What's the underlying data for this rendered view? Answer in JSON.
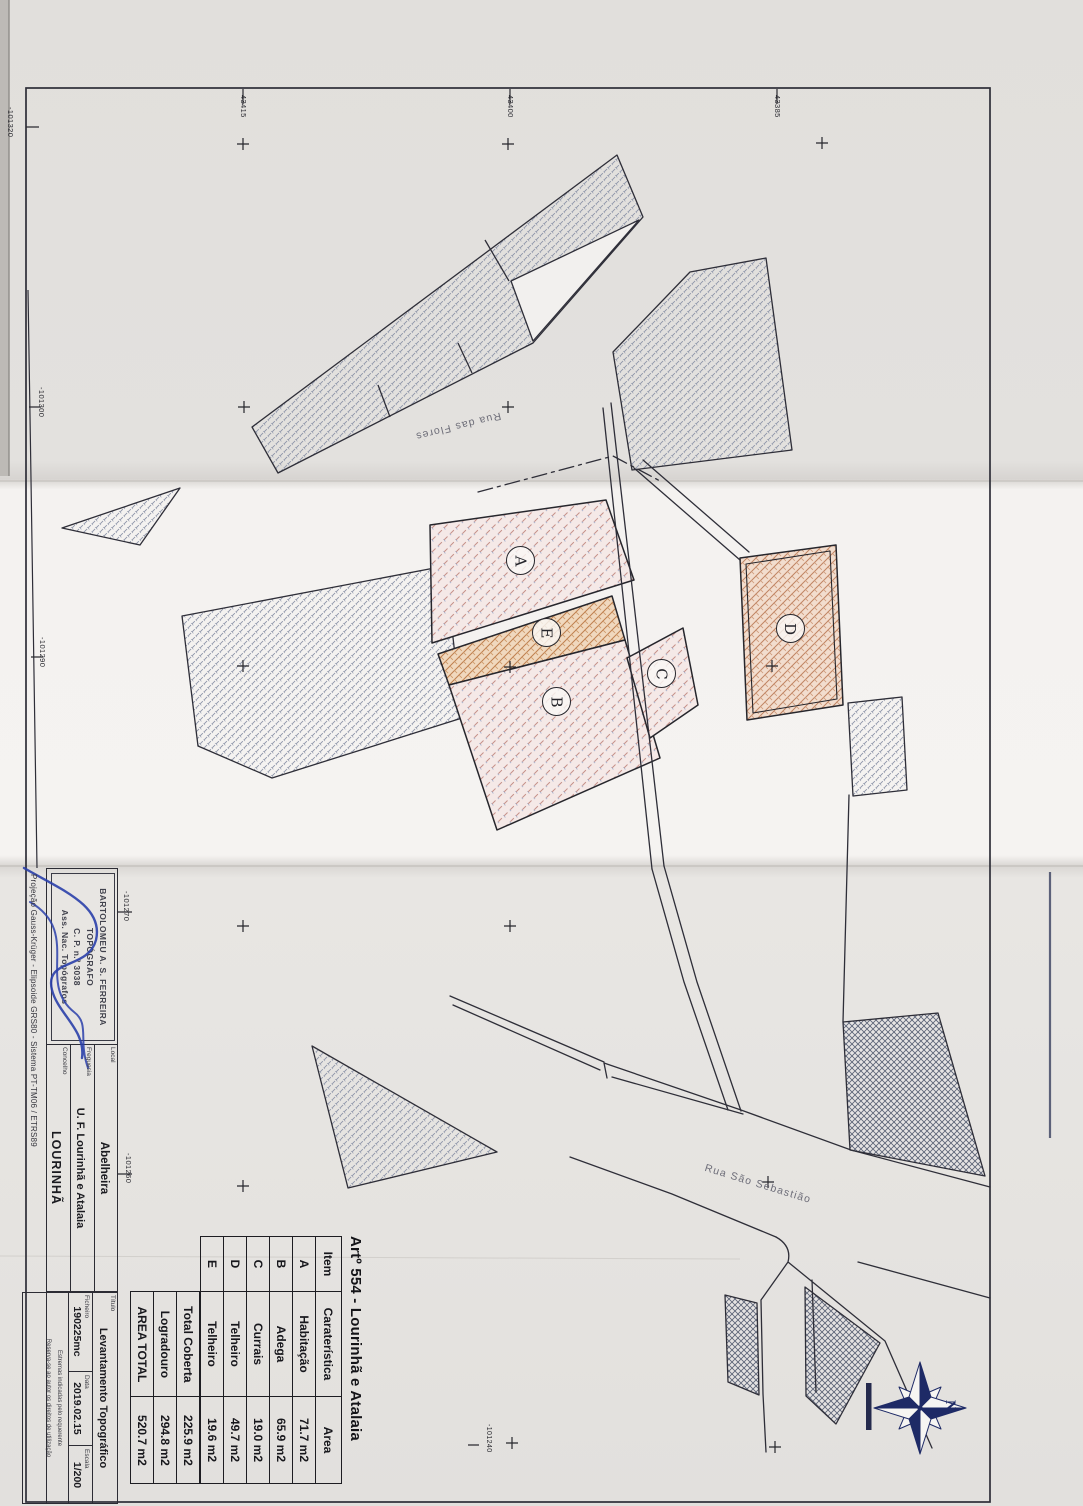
{
  "colors": {
    "paper_top": "#e3e1de",
    "paper_mid": "#f4f2f0",
    "paper_bottom": "#e5e3e0",
    "ink": "#2e2e38",
    "navy": "#1e2a66",
    "signature_blue": "#2a3faa",
    "pink_fill": "#f5e9e7",
    "orange_fill": "#f0d8be"
  },
  "plan": {
    "streets": [
      "Rua das Flores",
      "Rua São Sebastião"
    ],
    "building_labels": [
      "A",
      "B",
      "C",
      "D",
      "E"
    ],
    "north_label": "N",
    "coords_left": [
      "-101320",
      "-101300",
      "-101290",
      "-101270",
      "-101260"
    ],
    "coords_top": [
      "-43415",
      "-43400",
      "-43385"
    ],
    "coord_inner": "-101240"
  },
  "area_table": {
    "title": "Artº 554 - Lourinhã e Atalaia",
    "headers": [
      "Item",
      "Caraterística",
      "Area"
    ],
    "rows": [
      [
        "A",
        "Habitação",
        "71.7 m2"
      ],
      [
        "B",
        "Adega",
        "65.9 m2"
      ],
      [
        "C",
        "Currais",
        "19.0 m2"
      ],
      [
        "D",
        "Telheiro",
        "49.7 m2"
      ],
      [
        "E",
        "Telheiro",
        "19.6 m2"
      ]
    ],
    "summary": [
      [
        "Total Coberta",
        "225.9 m2"
      ],
      [
        "Logradouro",
        "294.8 m2"
      ],
      [
        "AREA TOTAL",
        "520.7 m2"
      ]
    ]
  },
  "title_block": {
    "stamp_lines": [
      "BARTOLOMEU A. S. FERREIRA",
      "TOPÓGRAFO",
      "C. P. n.º 3038",
      "Ass. Nac. Topógrafos"
    ],
    "projection": "Projeção Gauss-Krüger - Elipsoide GRS80 - Sistema PT-TM06 / ETRS89",
    "fields": [
      {
        "label": "Local",
        "value": "Abelheira"
      },
      {
        "label": "Freguesia",
        "value": "U. F. Lourinhã e Atalaia"
      },
      {
        "label": "Concelho",
        "value": "LOURINHÃ"
      }
    ],
    "titulo": {
      "label": "Título",
      "value": "Levantamento Topográfico"
    },
    "meta": [
      {
        "label": "Ficheiro",
        "value": "190225mc"
      },
      {
        "label": "Data",
        "value": "2019.02.15"
      },
      {
        "label": "Escala",
        "value": "1/200"
      }
    ],
    "notes": [
      "Estremas indicadas pelo requerente",
      "Reserva-se ao autor os direitos de utilização"
    ]
  }
}
